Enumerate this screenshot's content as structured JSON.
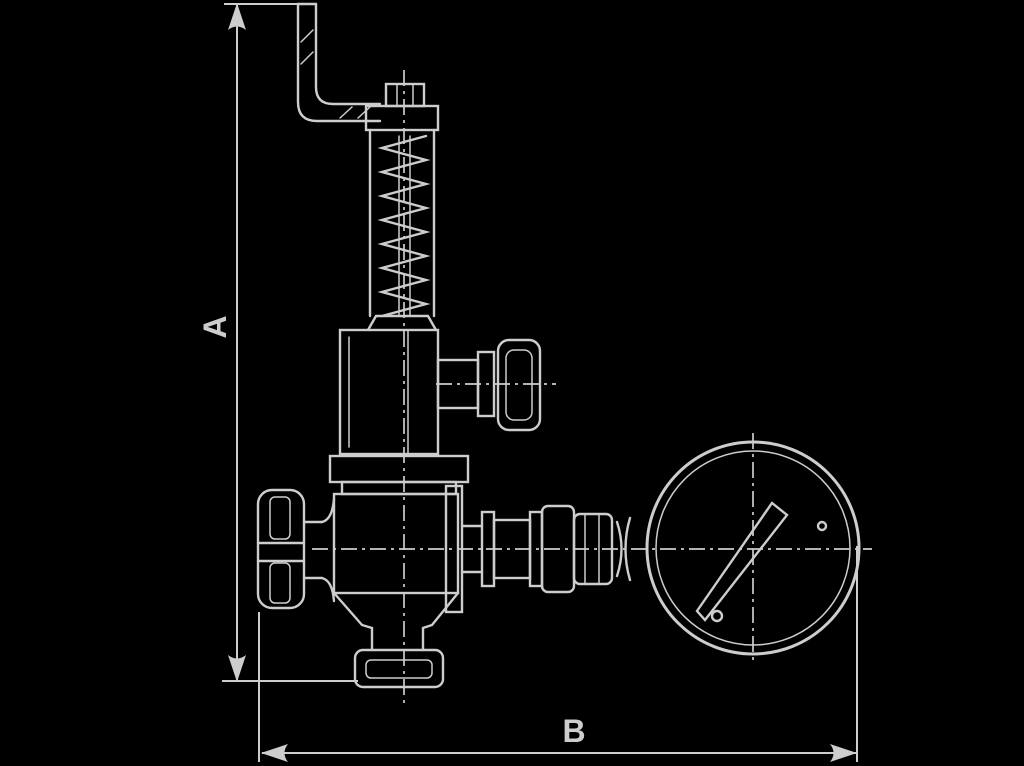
{
  "canvas": {
    "width": 1024,
    "height": 766,
    "background_color": "#000000",
    "line_color": "#cdcdcd"
  },
  "drawing": {
    "type": "technical-dimension-drawing",
    "subject": "safety relief valve with test lever, handwheel and pressure gauge"
  },
  "labels": {
    "vertical_dimension": "A",
    "horizontal_dimension": "B"
  }
}
